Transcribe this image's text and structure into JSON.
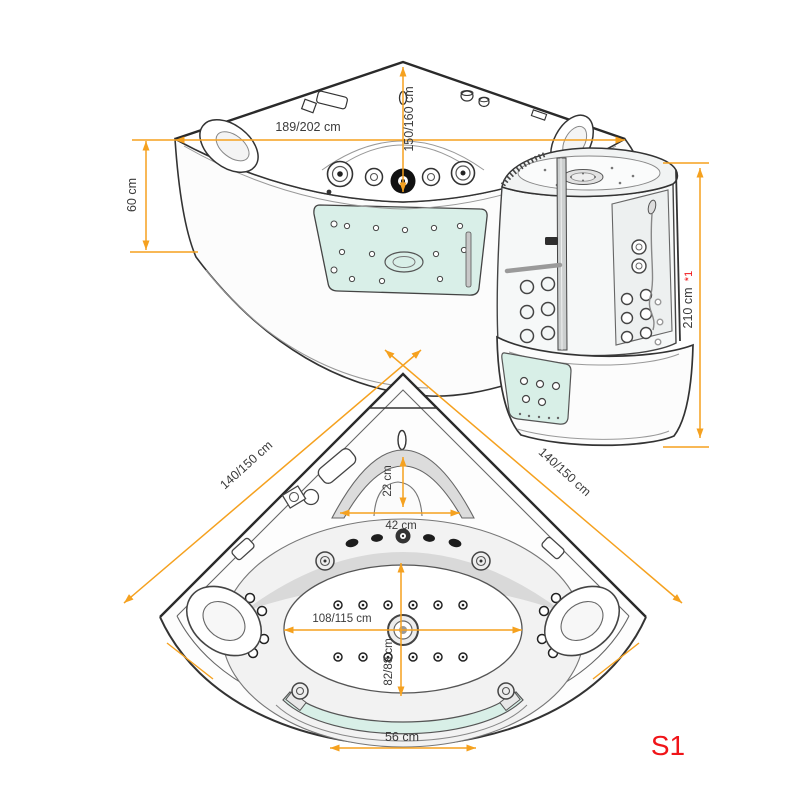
{
  "colors": {
    "dimension_accent": "#F5A11F",
    "highlight_red": "#F01418",
    "line_art": "#333333",
    "glass_tint": "#D8EFE7"
  },
  "perspective": {
    "width": "189/202 cm",
    "depth": "150/160 cm",
    "height": "60 cm"
  },
  "cabin": {
    "height": "210 cm",
    "footnote": "*1"
  },
  "plan": {
    "side_left": "140/150 cm",
    "side_right": "140/150 cm",
    "headrest_depth": "22 cm",
    "headrest_width": "42 cm",
    "inner_width": "108/115 cm",
    "inner_depth": "82/88 cm",
    "glass_width": "56 cm"
  },
  "model_code": "S1"
}
